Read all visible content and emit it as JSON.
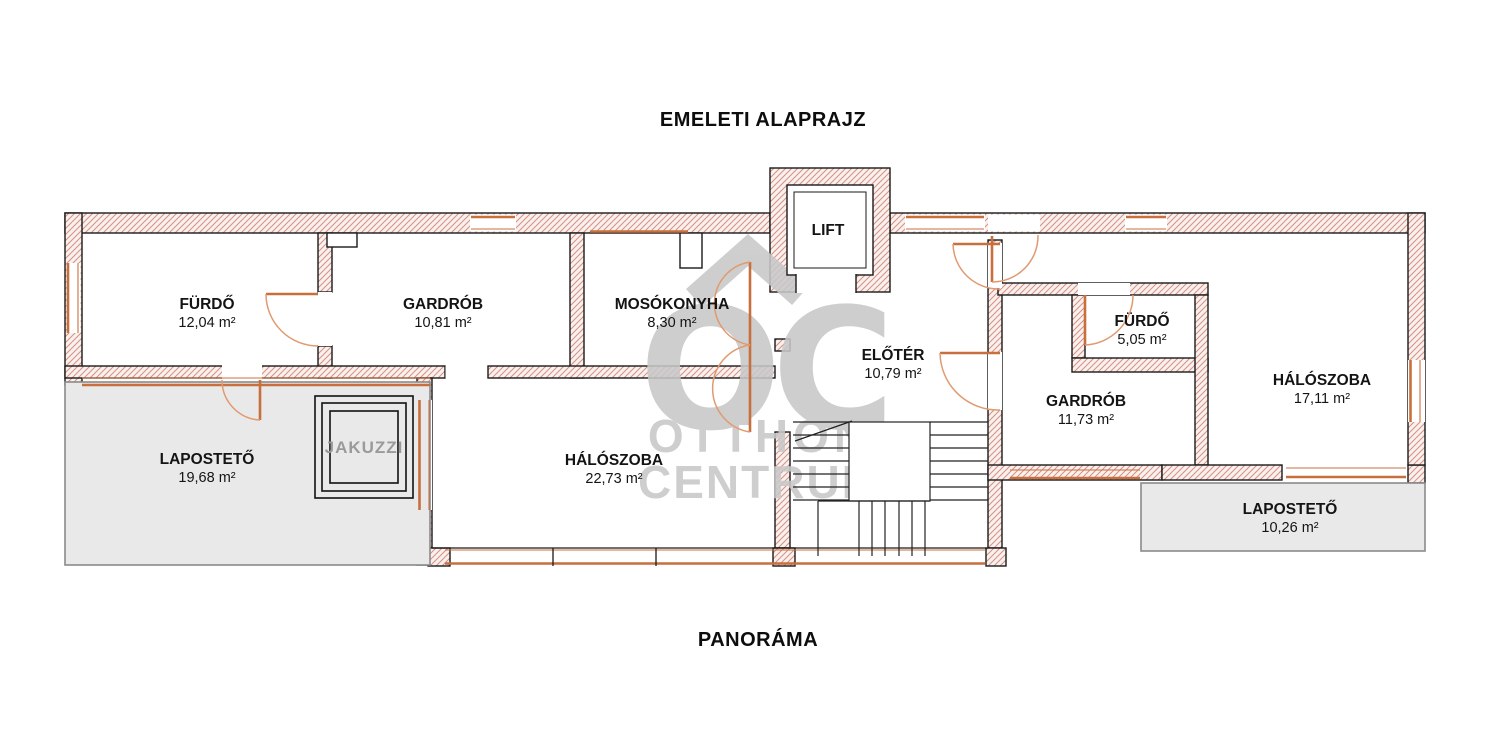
{
  "title": "EMELETI ALAPRAJZ",
  "footer": "PANORÁMA",
  "watermark": {
    "monogram": "OC",
    "line1": "OTTHON",
    "line2": "CENTRUM"
  },
  "rooms": [
    {
      "name": "FÜRDŐ",
      "area": "12,04 m²"
    },
    {
      "name": "GARDRÓB",
      "area": "10,81 m²"
    },
    {
      "name": "MOSÓKONYHA",
      "area": "8,30 m²"
    },
    {
      "name": "LIFT",
      "area": ""
    },
    {
      "name": "ELŐTÉR",
      "area": "10,79 m²"
    },
    {
      "name": "FÜRDŐ",
      "area": "5,05 m²"
    },
    {
      "name": "GARDRÓB",
      "area": "11,73 m²"
    },
    {
      "name": "HÁLÓSZOBA",
      "area": "17,11 m²"
    },
    {
      "name": "LAPOSTETŐ",
      "area": "19,68 m²"
    },
    {
      "name": "JAKUZZI",
      "area": ""
    },
    {
      "name": "HÁLÓSZOBA",
      "area": "22,73 m²"
    },
    {
      "name": "LAPOSTETŐ",
      "area": "10,26 m²"
    }
  ],
  "colors": {
    "wall_hatch": "#d49084",
    "wall_hatch_bg": "#faf1ee",
    "wall_outline": "#1a1a1a",
    "opening_orange": "#c86f3e",
    "door_arc": "#e09a70",
    "terrace_fill": "#e9e9e9",
    "terrace_border": "#8a8a8a",
    "watermark_gray": "#c8c8c8",
    "text": "#141414"
  }
}
